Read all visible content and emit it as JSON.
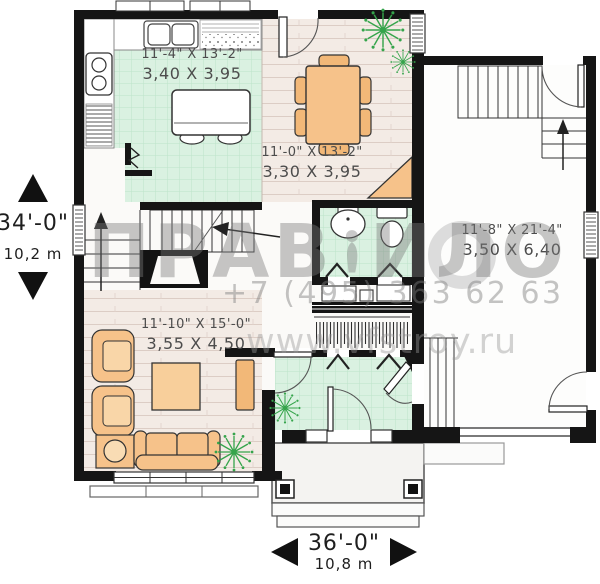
{
  "meta": {
    "type": "house-floor-plan"
  },
  "watermark": {
    "brand_left": "ПРАВ",
    "brand_right": "ИЛО",
    "phone": "+7 (495) 363 62 63",
    "website": "www.vfstroy.ru"
  },
  "overall": {
    "height": {
      "imperial": "34'-0\"",
      "metric": "10,2 m"
    },
    "width": {
      "imperial": "36'-0\"",
      "metric": "10,8 m"
    }
  },
  "rooms": {
    "kitchen": {
      "imperial": "11'-4\" X 13'-2\"",
      "metric": "3,40 X 3,95"
    },
    "dining": {
      "imperial": "11'-0\" X 13'-2\"",
      "metric": "3,30 X 3,95"
    },
    "living": {
      "imperial": "11'-10\" X 15'-0\"",
      "metric": "3,55 X 4,50"
    },
    "garage": {
      "imperial": "11'-8\" X 21'-4\"",
      "metric": "3,50 X 6,40"
    }
  },
  "colors": {
    "wall": "#151515",
    "floor_green": "#daf1e1",
    "floor_wood": "#f3ebe5",
    "furniture_orange": "#f6c28a",
    "plant_green": "#35a44b",
    "watermark_gray": "#8d8d8d"
  }
}
